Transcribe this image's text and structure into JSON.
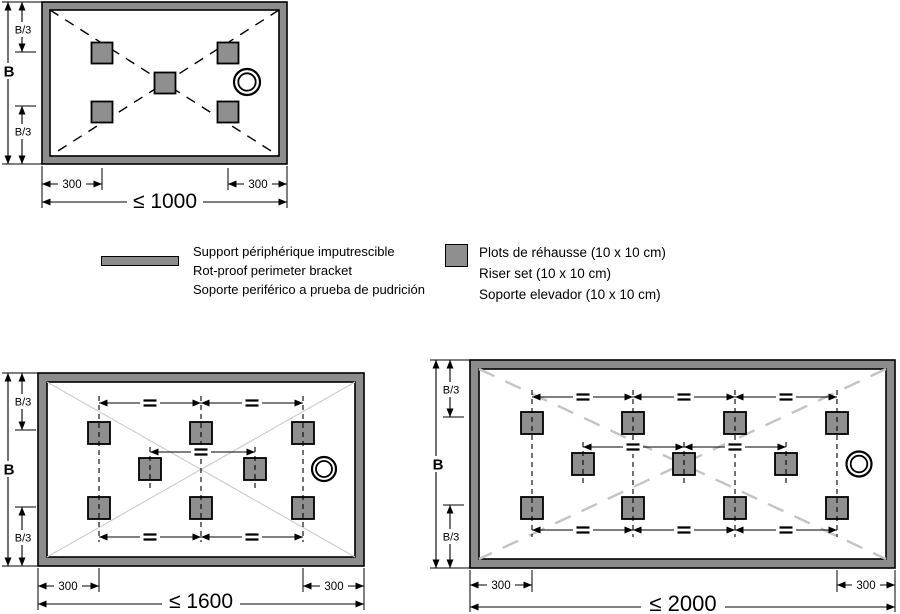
{
  "colors": {
    "frame_gray": "#8c8c8c",
    "plot_gray": "#8f8f8f",
    "diagonal_light": "#c9c9c9"
  },
  "dims": {
    "b": "B",
    "b3": "B/3",
    "edge": "300"
  },
  "trays": {
    "small": {
      "max": "≤ 1000",
      "plot_count": 5
    },
    "medium": {
      "max": "≤ 1600",
      "plot_count": 8
    },
    "large": {
      "max": "≤ 2000",
      "plot_count": 11
    }
  },
  "legend": {
    "bracket_lines": [
      "Support périphérique imputrescible",
      "Rot-proof perimeter bracket",
      "Soporte periférico a prueba de pudrición"
    ],
    "riser_lines": [
      "Plots de réhausse (10 x 10 cm)",
      "Riser set (10 x 10 cm)",
      "Soporte elevador (10 x 10 cm)"
    ]
  }
}
